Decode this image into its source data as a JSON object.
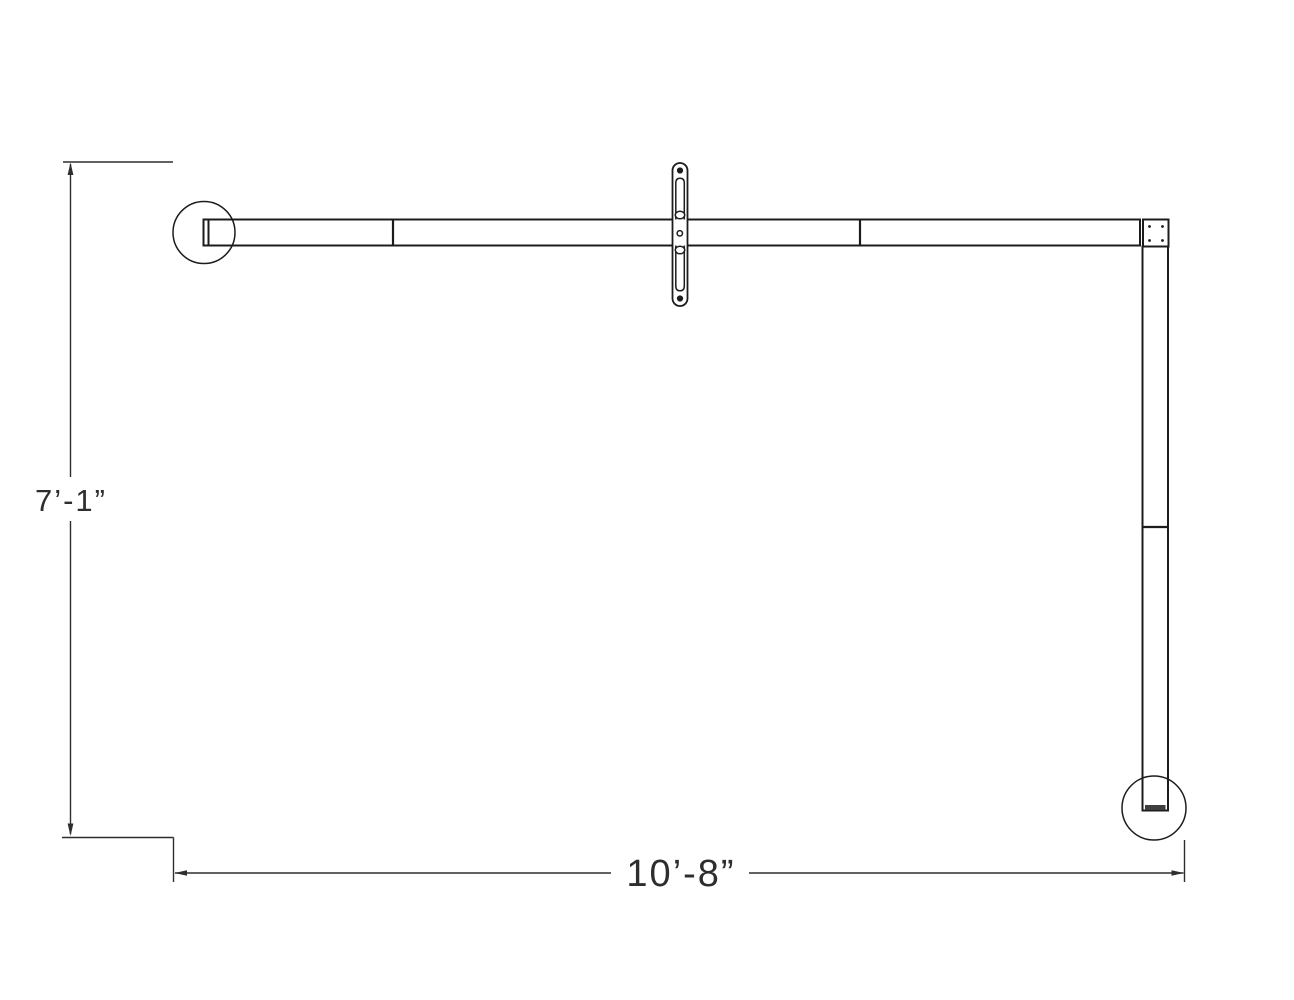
{
  "page": {
    "background": "#ffffff"
  },
  "drawing": {
    "type": "technical-dimension-drawing",
    "line_color": "#1c1c1c",
    "dimension_color": "#2e2e2e",
    "labels": {
      "height_dimension": "7’-1”",
      "width_dimension": "10’-8”"
    }
  }
}
